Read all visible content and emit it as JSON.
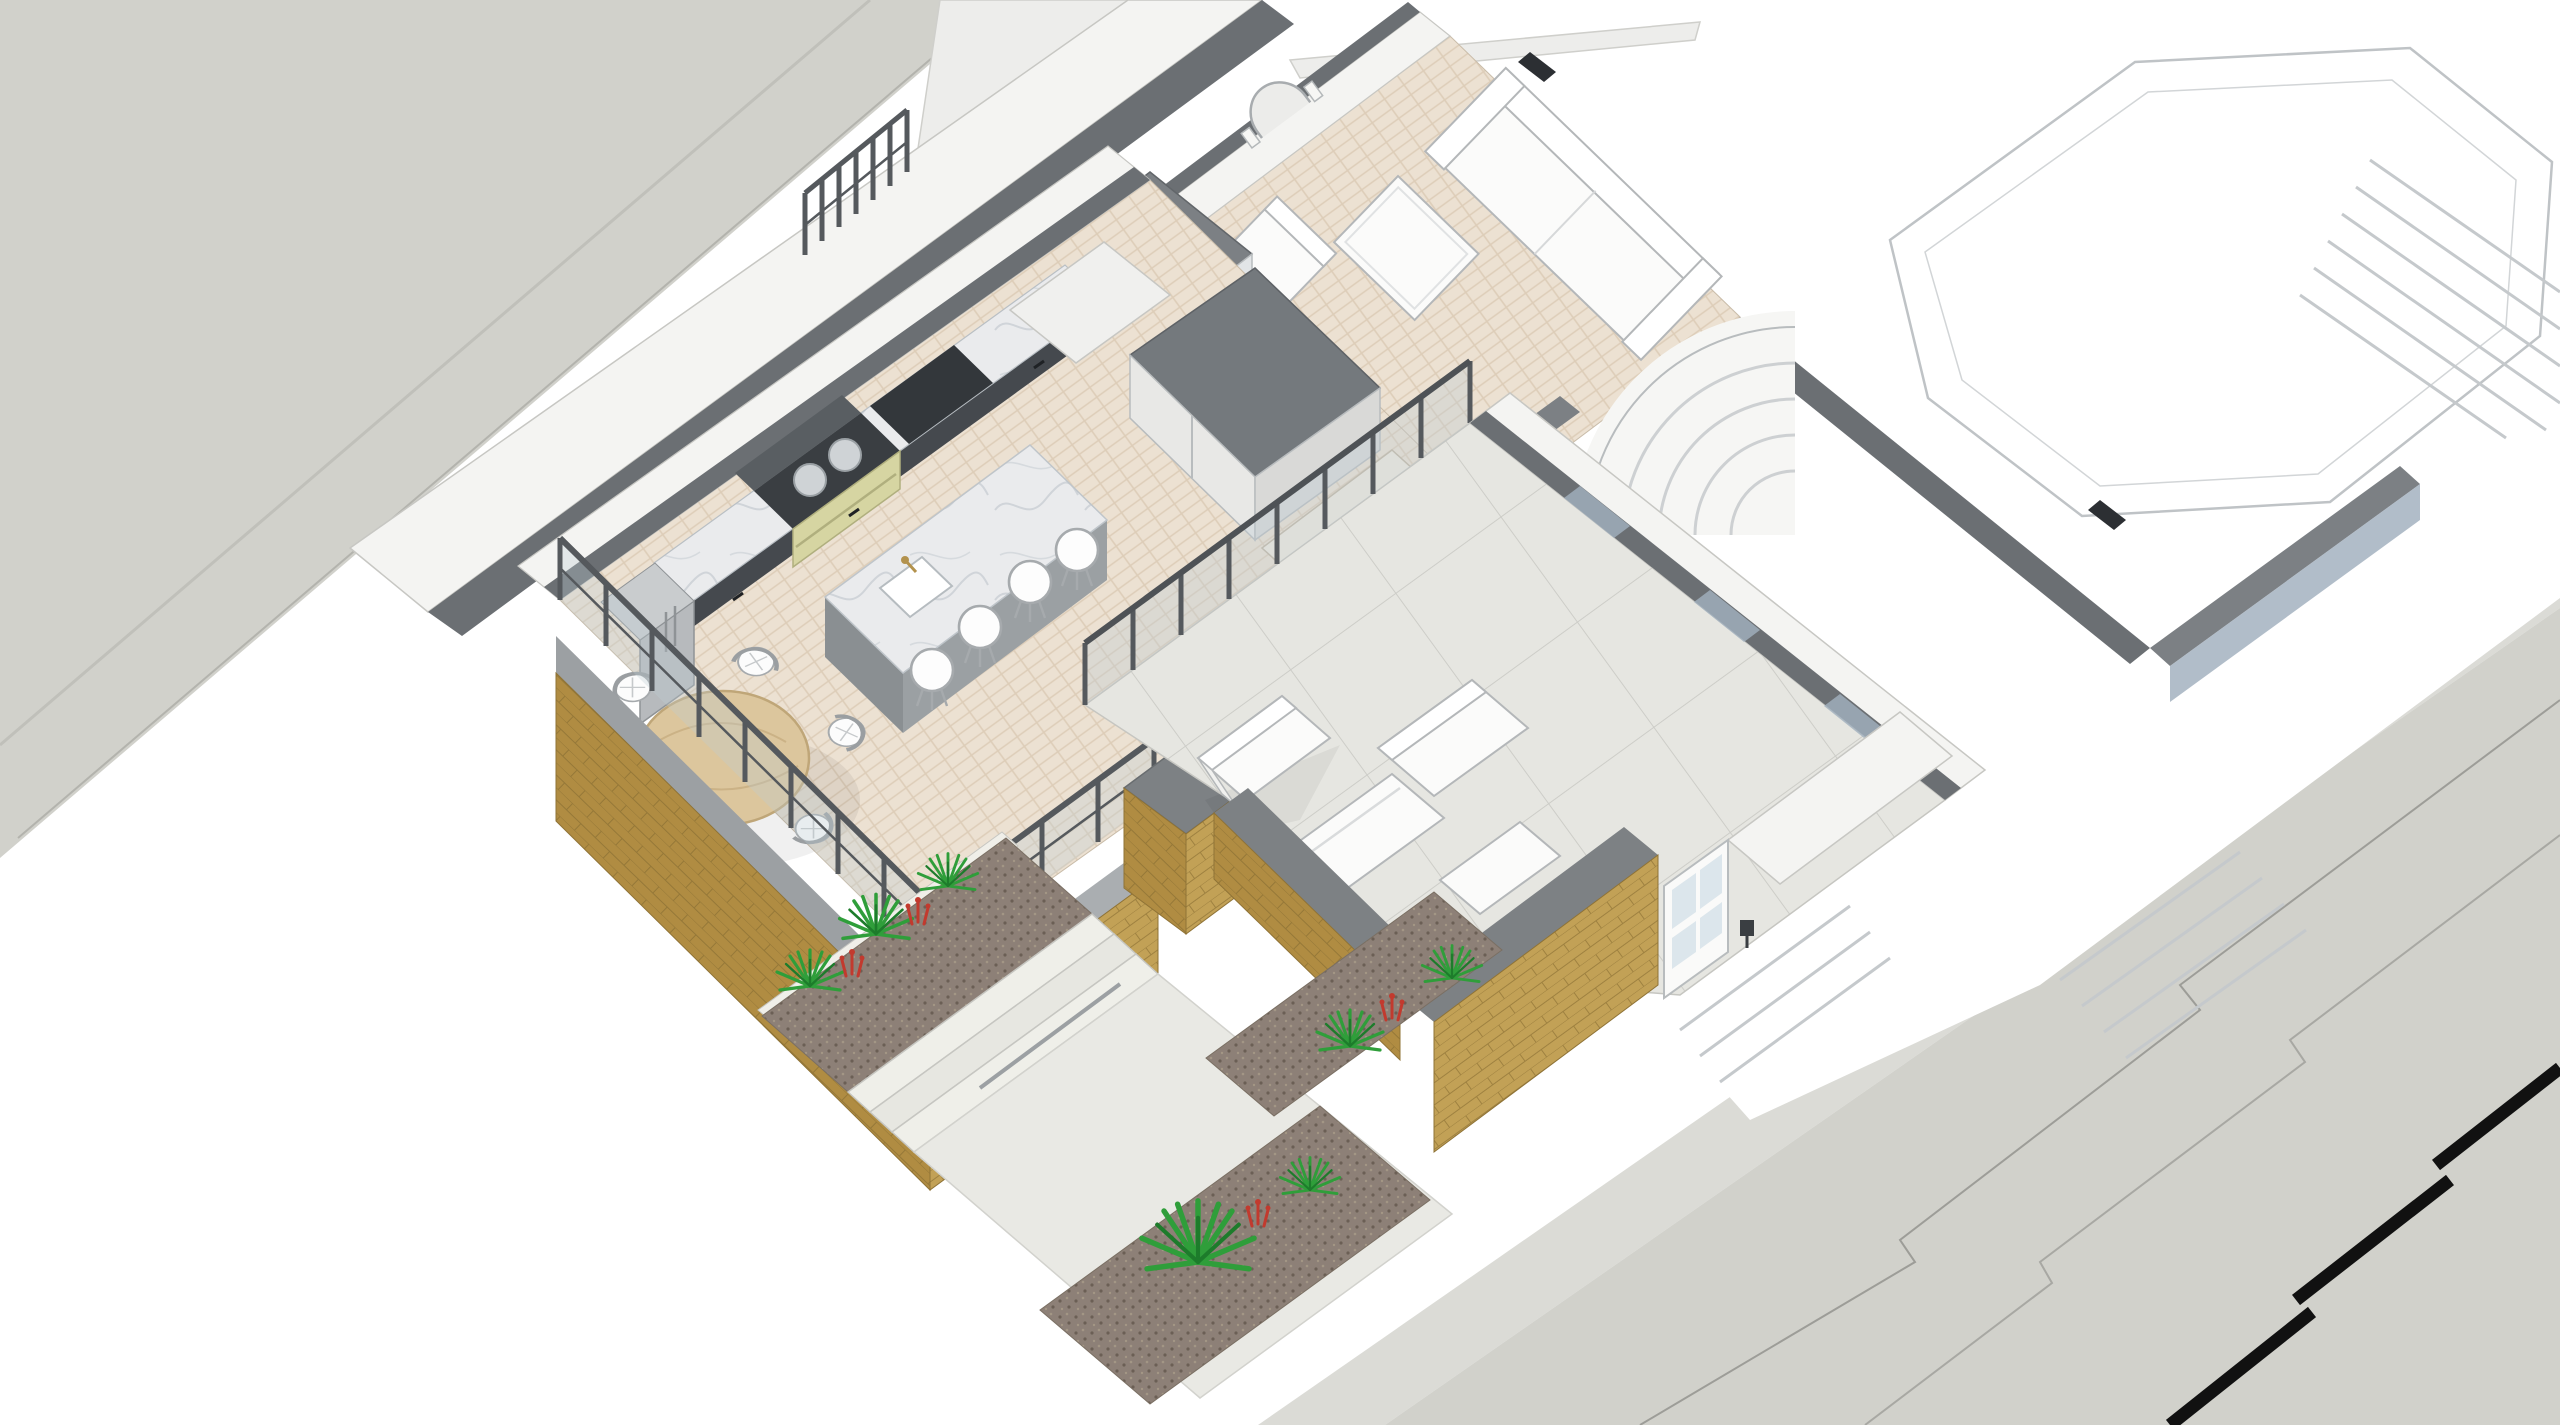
{
  "scene": {
    "view": "isometric-cutaway-floor-plan",
    "areas": {
      "street_front": "street (front)",
      "street_rear": "street (rear)",
      "kitchen": "kitchen",
      "dining": "dining area",
      "sitting_room": "sitting room",
      "hallway": "entrance hall",
      "terrace": "rear terrace",
      "garden": "garden with planters and steps",
      "neighbour": "adjoining building (white massing)"
    },
    "counts": {
      "dining_chairs": 6,
      "bar_stools": 4,
      "range_lids": 2,
      "outdoor_seats": 4
    }
  },
  "colors": {
    "bg": "#ffffff",
    "road": "#d1d1cb",
    "road_light": "#dbdbd6",
    "boundary_black": "#111111",
    "wall_white": "#f4f4f2",
    "wall_edge": "#c7c7c3",
    "wall_top": "#6b6f73",
    "wall_top_light": "#7c8084",
    "wall_face_blue": "#a3b2bf",
    "ghost_line": "#bfc3c6",
    "floor_wood": "#ece1d2",
    "floor_wood_line": "#d9c8b1",
    "marble": "#eaebed",
    "marble_vein": "#c5cbd1",
    "cabinet": "#45494e",
    "counter_dark": "#33373b",
    "splash": "#595e62",
    "aga_cream": "#d6d5a2",
    "aga_lid": "#cfd3d6",
    "fridge_steel": "#b7babd",
    "island_base": "#9ba0a3",
    "island_base_dark": "#8a8f92",
    "stool_white": "#fdfdfd",
    "stool_edge": "#a6aaad",
    "table_wood": "#dcc69d",
    "table_edge": "#bfa678",
    "chair_white": "#fcfcfc",
    "railing": "#55595d",
    "glass": "#bdccd4",
    "brick": "#b08c42",
    "brick_light": "#c2a156",
    "brick_line": "#8f7336",
    "coping": "#7d8184",
    "slab": "#9ca0a3",
    "patio": "#e6e6e1",
    "patio_joint": "#cdcdc8",
    "paving": "#e9e9e4",
    "step": "#efefe9",
    "step_edge": "#c6c6c1",
    "gravel": "#8d8077",
    "gravel_dot": "#6b5f55",
    "plant": "#2f9e3a",
    "plant_dark": "#1d7c2b",
    "flower": "#c23a2e",
    "tile_blue": "#93a3ba",
    "sofa_white": "#fbfbfa",
    "sofa_edge": "#b4b7b9",
    "door_glass": "#dce6ec",
    "brass": "#b3924d"
  }
}
